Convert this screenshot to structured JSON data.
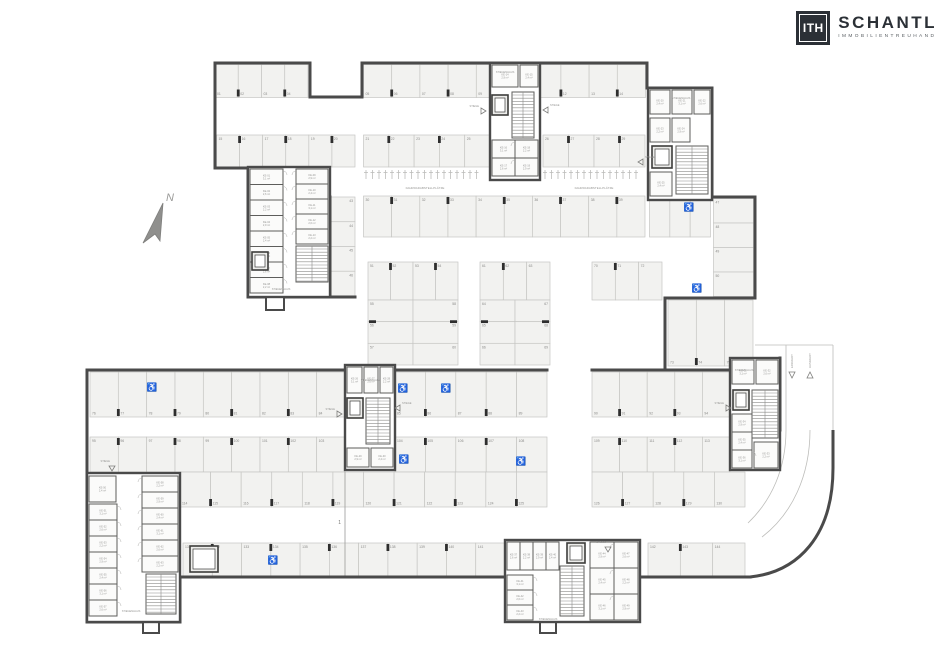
{
  "logo": {
    "initials": "ITH",
    "name": "SCHANTL",
    "subtitle": "IMMOBILIENTREUHAND"
  },
  "compass": {
    "label": "N"
  },
  "annotations": {
    "bike_label": "FAHRRADABSTELLPLÄTZE",
    "stair_label": "STIEGENHAUS",
    "access_label": "STIEGE",
    "entry_label": "EINFAHRT",
    "exit_label": "AUSFAHRT",
    "section_label": "1",
    "room_prefix": "KE",
    "area_samples": [
      "2,4 m²",
      "3,1 m²",
      "2,6 m²",
      "2,2 m²",
      "2,9 m²"
    ]
  },
  "colors": {
    "wall": "#4a4a4a",
    "inner_wall": "#5d5d5b",
    "stall_fill": "#f2f2f0",
    "stall_line": "#c6c6c3",
    "tick": "#2e2e2e",
    "num_text": "#8a8a88",
    "tiny_text": "#979795",
    "thin_line": "#bdbdba",
    "icon": "#7d7d7b",
    "north": "#8f8f8d",
    "room_fill": "#fbfbfa",
    "elev_fill": "#ededeb"
  },
  "plan": {
    "walls": [
      [
        215,
        63,
        310,
        63
      ],
      [
        310,
        63,
        310,
        97
      ],
      [
        310,
        97,
        362,
        97
      ],
      [
        362,
        97,
        362,
        63
      ],
      [
        362,
        63,
        647,
        63
      ],
      [
        647,
        63,
        647,
        88
      ],
      [
        647,
        88,
        712,
        88
      ],
      [
        712,
        88,
        712,
        197
      ],
      [
        712,
        197,
        755,
        197
      ],
      [
        755,
        197,
        755,
        298
      ],
      [
        755,
        298,
        665,
        298
      ],
      [
        665,
        298,
        665,
        368
      ],
      [
        215,
        63,
        215,
        168
      ],
      [
        215,
        168,
        248,
        168
      ],
      [
        248,
        168,
        248,
        297
      ],
      [
        248,
        297,
        355,
        297
      ],
      [
        330,
        197,
        330,
        297
      ],
      [
        87,
        370,
        345,
        370
      ],
      [
        392,
        370,
        547,
        370
      ],
      [
        592,
        370,
        730,
        370
      ],
      [
        87,
        370,
        87,
        622
      ],
      [
        87,
        622,
        180,
        622
      ],
      [
        180,
        622,
        180,
        577
      ],
      [
        180,
        577,
        505,
        577
      ],
      [
        640,
        577,
        750,
        577
      ],
      [
        780,
        358,
        780,
        430
      ]
    ],
    "wall_rects": [
      {
        "x": 266,
        "y": 297,
        "w": 18,
        "h": 13
      },
      {
        "x": 143,
        "y": 622,
        "w": 16,
        "h": 11
      },
      {
        "x": 540,
        "y": 622,
        "w": 16,
        "h": 11
      }
    ],
    "stall_rows": [
      {
        "x": 215,
        "y": 64.5,
        "w": 93,
        "h": 33,
        "n": 4,
        "dir": "v",
        "num": "b",
        "start": 1,
        "ticks": true
      },
      {
        "x": 363.5,
        "y": 64.5,
        "w": 282,
        "h": 33,
        "n": 10,
        "dir": "v",
        "num": "b",
        "start": 5,
        "ticks": true
      },
      {
        "x": 216.5,
        "y": 135,
        "w": 138.5,
        "h": 32,
        "n": 6,
        "dir": "v",
        "num": "t",
        "start": 15,
        "ticks": true
      },
      {
        "x": 363.5,
        "y": 135,
        "w": 126.5,
        "h": 32,
        "n": 5,
        "dir": "v",
        "num": "t",
        "start": 21,
        "ticks": true
      },
      {
        "x": 543,
        "y": 135,
        "w": 102,
        "h": 32,
        "n": 4,
        "dir": "v",
        "num": "t",
        "start": 26,
        "ticks": true
      },
      {
        "x": 363.5,
        "y": 196,
        "w": 281.5,
        "h": 41,
        "n": 10,
        "dir": "v",
        "num": "t",
        "start": 30,
        "ticks": true
      },
      {
        "x": 649.5,
        "y": 196,
        "w": 61,
        "h": 41,
        "n": 3,
        "dir": "v",
        "num": "t",
        "start": 40,
        "ticks": false
      },
      {
        "x": 331,
        "y": 197,
        "w": 24,
        "h": 99,
        "n": 4,
        "dir": "h",
        "num": "r",
        "start": 43,
        "ticks": false
      },
      {
        "x": 713.5,
        "y": 198.5,
        "w": 40,
        "h": 98,
        "n": 4,
        "dir": "h",
        "num": "l",
        "start": 47,
        "ticks": false
      },
      {
        "x": 368,
        "y": 262,
        "w": 90,
        "h": 38,
        "n": 4,
        "dir": "v",
        "num": "t",
        "start": 51,
        "ticks": true
      },
      {
        "x": 368,
        "y": 300,
        "w": 45,
        "h": 65,
        "n": 3,
        "dir": "h",
        "num": "l",
        "start": 55,
        "ticks": true
      },
      {
        "x": 413,
        "y": 300,
        "w": 45,
        "h": 65,
        "n": 3,
        "dir": "h",
        "num": "r",
        "start": 58,
        "ticks": true
      },
      {
        "x": 480,
        "y": 262,
        "w": 70,
        "h": 38,
        "n": 3,
        "dir": "v",
        "num": "t",
        "start": 61,
        "ticks": true
      },
      {
        "x": 480,
        "y": 300,
        "w": 35,
        "h": 65,
        "n": 3,
        "dir": "h",
        "num": "l",
        "start": 64,
        "ticks": true
      },
      {
        "x": 515,
        "y": 300,
        "w": 35,
        "h": 65,
        "n": 3,
        "dir": "h",
        "num": "r",
        "start": 67,
        "ticks": true
      },
      {
        "x": 592,
        "y": 262,
        "w": 70,
        "h": 38,
        "n": 3,
        "dir": "v",
        "num": "t",
        "start": 70,
        "ticks": true
      },
      {
        "x": 668,
        "y": 300,
        "w": 85,
        "h": 66,
        "n": 3,
        "dir": "v",
        "num": "b",
        "start": 73,
        "ticks": true
      },
      {
        "x": 90,
        "y": 372,
        "w": 255,
        "h": 45,
        "n": 9,
        "dir": "v",
        "num": "b",
        "start": 76,
        "ticks": true
      },
      {
        "x": 395,
        "y": 372,
        "w": 152,
        "h": 45,
        "n": 5,
        "dir": "v",
        "num": "b",
        "start": 85,
        "ticks": true
      },
      {
        "x": 592,
        "y": 372,
        "w": 138,
        "h": 45,
        "n": 5,
        "dir": "v",
        "num": "b",
        "start": 90,
        "ticks": true
      },
      {
        "x": 90,
        "y": 437,
        "w": 255,
        "h": 35,
        "n": 9,
        "dir": "v",
        "num": "t",
        "start": 95,
        "ticks": true
      },
      {
        "x": 395,
        "y": 437,
        "w": 152,
        "h": 35,
        "n": 5,
        "dir": "v",
        "num": "t",
        "start": 104,
        "ticks": true
      },
      {
        "x": 592,
        "y": 437,
        "w": 138,
        "h": 35,
        "n": 5,
        "dir": "v",
        "num": "t",
        "start": 109,
        "ticks": true
      },
      {
        "x": 180,
        "y": 472,
        "w": 367,
        "h": 35,
        "n": 12,
        "dir": "v",
        "num": "b",
        "start": 114,
        "ticks": true
      },
      {
        "x": 592,
        "y": 472,
        "w": 153,
        "h": 35,
        "n": 5,
        "dir": "v",
        "num": "b",
        "start": 126,
        "ticks": true
      },
      {
        "x": 183,
        "y": 543,
        "w": 322,
        "h": 34,
        "n": 11,
        "dir": "v",
        "num": "t",
        "start": 131,
        "ticks": true
      },
      {
        "x": 648,
        "y": 543,
        "w": 97,
        "h": 34,
        "n": 3,
        "dir": "v",
        "num": "t",
        "start": 142,
        "ticks": true
      }
    ],
    "cores": [
      {
        "id": "core-top-left",
        "x": 248,
        "y": 167,
        "w": 82,
        "h": 130,
        "room_cols": [
          {
            "x": 250,
            "y": 169,
            "w": 33,
            "ch": 15.5,
            "n": 8,
            "face": "r"
          },
          {
            "x": 296,
            "y": 169,
            "w": 32,
            "ch": 15,
            "n": 5,
            "face": "l"
          }
        ],
        "stair": {
          "x": 296,
          "y": 246,
          "w": 32,
          "h": 36,
          "o": "v"
        },
        "elev": {
          "x": 252,
          "y": 252,
          "w": 16,
          "h": 18
        },
        "stair_label": {
          "x": 281,
          "y": 290
        }
      },
      {
        "id": "core-top-mid",
        "x": 490,
        "y": 63,
        "w": 50,
        "h": 117,
        "rooms_abs": [
          {
            "x": 492,
            "y": 65,
            "w": 26,
            "h": 22
          },
          {
            "x": 520,
            "y": 65,
            "w": 18,
            "h": 22
          }
        ],
        "room_cols": [
          {
            "x": 492,
            "y": 140,
            "w": 23,
            "ch": 18,
            "n": 2,
            "face": "r"
          },
          {
            "x": 515,
            "y": 140,
            "w": 23,
            "ch": 18,
            "n": 2,
            "face": "l"
          }
        ],
        "stair": {
          "x": 512,
          "y": 92,
          "w": 22,
          "h": 46,
          "o": "v"
        },
        "elev": {
          "x": 492,
          "y": 95,
          "w": 16,
          "h": 20
        },
        "stair_label": {
          "x": 505,
          "y": 73
        }
      },
      {
        "id": "core-top-right",
        "x": 648,
        "y": 88,
        "w": 64,
        "h": 112,
        "rooms_abs": [
          {
            "x": 650,
            "y": 90,
            "w": 20,
            "h": 24
          },
          {
            "x": 672,
            "y": 90,
            "w": 20,
            "h": 24
          },
          {
            "x": 694,
            "y": 90,
            "w": 16,
            "h": 24
          },
          {
            "x": 650,
            "y": 118,
            "w": 20,
            "h": 24
          },
          {
            "x": 672,
            "y": 118,
            "w": 18,
            "h": 24
          },
          {
            "x": 650,
            "y": 172,
            "w": 22,
            "h": 24
          }
        ],
        "room_cols": [],
        "stair": {
          "x": 676,
          "y": 146,
          "w": 32,
          "h": 48,
          "o": "v"
        },
        "elev": {
          "x": 652,
          "y": 146,
          "w": 20,
          "h": 22
        },
        "stair_label": {
          "x": 681,
          "y": 99
        }
      },
      {
        "id": "core-mid-left",
        "x": 345,
        "y": 365,
        "w": 50,
        "h": 105,
        "rooms_abs": [
          {
            "x": 347,
            "y": 367,
            "w": 15,
            "h": 26
          },
          {
            "x": 364,
            "y": 367,
            "w": 14,
            "h": 26
          },
          {
            "x": 380,
            "y": 367,
            "w": 13,
            "h": 26
          },
          {
            "x": 347,
            "y": 448,
            "w": 22,
            "h": 19
          },
          {
            "x": 371,
            "y": 448,
            "w": 22,
            "h": 19
          }
        ],
        "room_cols": [],
        "stair": {
          "x": 366,
          "y": 398,
          "w": 24,
          "h": 46,
          "o": "v"
        },
        "elev": {
          "x": 347,
          "y": 398,
          "w": 16,
          "h": 20
        },
        "stair_label": {
          "x": 370,
          "y": 381
        }
      },
      {
        "id": "core-bot-right",
        "x": 730,
        "y": 358,
        "w": 50,
        "h": 112,
        "rooms_abs": [
          {
            "x": 732,
            "y": 360,
            "w": 22,
            "h": 24
          },
          {
            "x": 756,
            "y": 360,
            "w": 22,
            "h": 24
          },
          {
            "x": 754,
            "y": 442,
            "w": 24,
            "h": 26
          }
        ],
        "room_cols": [
          {
            "x": 732,
            "y": 414,
            "w": 20,
            "ch": 18,
            "n": 3,
            "face": "r"
          }
        ],
        "stair": {
          "x": 752,
          "y": 390,
          "w": 26,
          "h": 48,
          "o": "v"
        },
        "elev": {
          "x": 733,
          "y": 390,
          "w": 16,
          "h": 20
        },
        "stair_label": {
          "x": 744,
          "y": 371
        }
      },
      {
        "id": "core-bot-mid",
        "x": 505,
        "y": 540,
        "w": 135,
        "h": 82,
        "rooms_abs": [
          {
            "x": 507,
            "y": 542,
            "w": 13,
            "h": 28
          },
          {
            "x": 520,
            "y": 542,
            "w": 13,
            "h": 28
          },
          {
            "x": 533,
            "y": 542,
            "w": 13,
            "h": 28
          },
          {
            "x": 546,
            "y": 542,
            "w": 13,
            "h": 28
          }
        ],
        "room_cols": [
          {
            "x": 507,
            "y": 575,
            "w": 26,
            "ch": 15,
            "n": 3,
            "face": "r"
          },
          {
            "x": 590,
            "y": 542,
            "w": 24,
            "ch": 26,
            "n": 3,
            "face": "r"
          },
          {
            "x": 614,
            "y": 542,
            "w": 24,
            "ch": 26,
            "n": 3,
            "face": "l"
          }
        ],
        "stair": {
          "x": 560,
          "y": 566,
          "w": 24,
          "h": 50,
          "o": "v"
        },
        "elev": {
          "x": 567,
          "y": 543,
          "w": 18,
          "h": 20
        },
        "stair_label": {
          "x": 548,
          "y": 620
        }
      },
      {
        "id": "core-bot-left",
        "x": 87,
        "y": 473,
        "w": 93,
        "h": 149,
        "rooms_abs": [
          {
            "x": 89,
            "y": 476,
            "w": 27,
            "h": 26
          }
        ],
        "room_cols": [
          {
            "x": 89,
            "y": 504,
            "w": 28,
            "ch": 16,
            "n": 7,
            "face": "r"
          },
          {
            "x": 142,
            "y": 476,
            "w": 36,
            "ch": 16,
            "n": 6,
            "face": "l"
          }
        ],
        "stair": {
          "x": 146,
          "y": 574,
          "w": 30,
          "h": 40,
          "o": "v"
        },
        "elev": null,
        "stair_label": {
          "x": 131,
          "y": 612
        }
      }
    ],
    "elevators_abs": [
      {
        "x": 190,
        "y": 546,
        "w": 28,
        "h": 26
      }
    ],
    "bike_groups": [
      {
        "x": 366,
        "y": 170,
        "n": 18,
        "label": true,
        "lx": 425,
        "ly": 189
      },
      {
        "x": 545,
        "y": 170,
        "n": 15,
        "label": true,
        "lx": 594,
        "ly": 189
      },
      {
        "x": 652,
        "y": 170,
        "n": 9,
        "label": false,
        "lx": 0,
        "ly": 0
      }
    ],
    "wheel_icons": [
      {
        "x": 689,
        "y": 207
      },
      {
        "x": 697,
        "y": 288
      },
      {
        "x": 152,
        "y": 387
      },
      {
        "x": 403,
        "y": 388
      },
      {
        "x": 446,
        "y": 388
      },
      {
        "x": 404,
        "y": 459
      },
      {
        "x": 521,
        "y": 461
      },
      {
        "x": 273,
        "y": 560
      }
    ],
    "access_markers": [
      {
        "x": 481,
        "y": 111,
        "d": "r"
      },
      {
        "x": 548,
        "y": 110,
        "d": "l"
      },
      {
        "x": 643,
        "y": 162,
        "d": "l"
      },
      {
        "x": 337,
        "y": 414,
        "d": "r"
      },
      {
        "x": 400,
        "y": 408,
        "d": "l"
      },
      {
        "x": 726,
        "y": 408,
        "d": "r"
      },
      {
        "x": 608,
        "y": 547,
        "d": "d"
      },
      {
        "x": 112,
        "y": 466,
        "d": "d"
      }
    ],
    "ramp": {
      "thin_lines": [
        [
          786,
          345,
          786,
          430
        ],
        [
          833,
          345,
          833,
          430
        ],
        [
          786,
          345,
          833,
          345
        ],
        [
          755,
          345,
          786,
          345
        ]
      ],
      "thin_curves": [
        "M786,430 C786,468 772,500 748,523",
        "M810,430 C810,476 792,514 762,537"
      ],
      "thick_curve": "M750,577 C798,572 833,536 833,468 L833,430",
      "arrows": [
        {
          "x": 792,
          "y": 372,
          "d": "d",
          "label": "entry_label"
        },
        {
          "x": 810,
          "y": 372,
          "d": "u",
          "label": "exit_label"
        }
      ]
    },
    "section_line": {
      "x": 345,
      "y1": 472,
      "y2": 577,
      "lx": 341,
      "ly": 524
    },
    "north": {
      "cx": 152,
      "cy": 228
    }
  }
}
